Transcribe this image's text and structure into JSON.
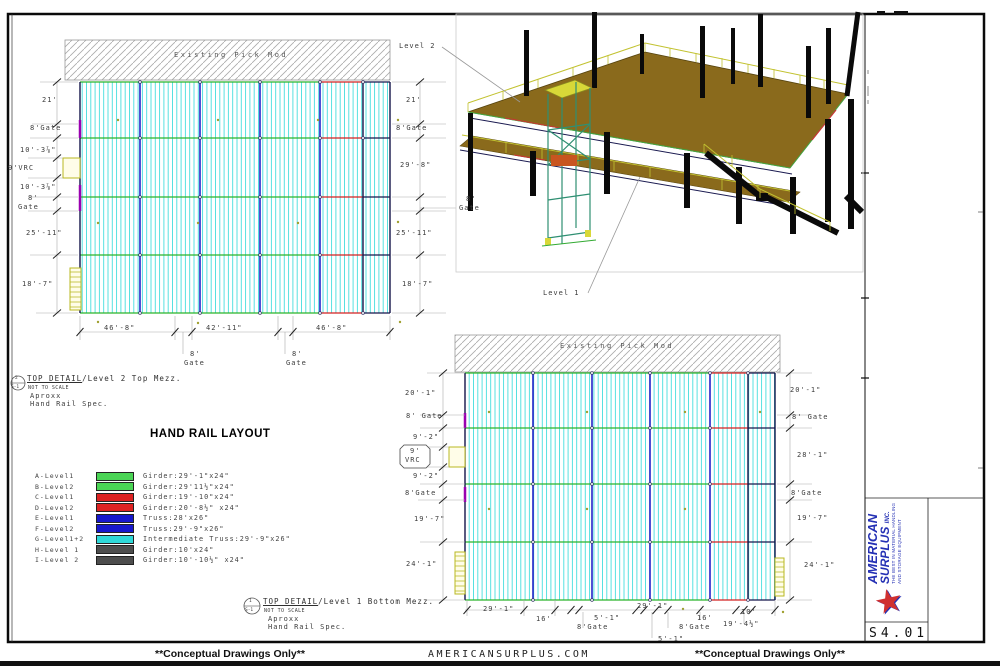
{
  "sheet": {
    "number": "S4.01"
  },
  "footer": {
    "left": "**Conceptual Drawings Only**",
    "center": "AMERICANSURPLUS.COM",
    "right": "**Conceptual Drawings Only**"
  },
  "logo": {
    "line1": "AMERICAN",
    "line2": "SURPLUS",
    "suffix": "INC.",
    "tagline1": "THE BEST IN MATERIAL HANDLING",
    "tagline2": "AND STORAGE EQUIPMENT"
  },
  "view3d": {
    "level2_label": "Level 2",
    "level1_label": "Level 1"
  },
  "legend": {
    "title": "HAND RAIL LAYOUT",
    "items": [
      {
        "key": "A-Level1",
        "color": "#4ad455",
        "label": "Girder:29'-1\"x24\""
      },
      {
        "key": "B-Level2",
        "color": "#4ad455",
        "label": "Girder:29'11½\"x24\""
      },
      {
        "key": "C-Level1",
        "color": "#dd2222",
        "label": "Girder:19'-10\"x24\""
      },
      {
        "key": "D-Level2",
        "color": "#dd2222",
        "label": "Girder:20'-8½\" x24\""
      },
      {
        "key": "E-Level1",
        "color": "#1717cc",
        "label": "Truss:28'x26\""
      },
      {
        "key": "F-Level2",
        "color": "#1717cc",
        "label": "Truss:29'-9\"x26\""
      },
      {
        "key": "G-Level1+2",
        "color": "#2fd8d8",
        "label": "Intermediate Truss:29'-9\"x26\""
      },
      {
        "key": "H-Level 1",
        "color": "#4d4d4d",
        "label": "Girder:10'x24\""
      },
      {
        "key": "I-Level 2",
        "color": "#4d4d4d",
        "label": "Girder:10'-10½\" x24\""
      }
    ]
  },
  "plan2": {
    "existing": "Existing Pick Mod",
    "left": {
      "d1": "21'",
      "d2": "8'Gate",
      "d3": "10'-3⅞\"",
      "d4": "9'VRC",
      "d5": "10'-3⅞\"",
      "d6": "8'",
      "d7": "Gate",
      "d8": "25'-11\"",
      "d9": "18'-7\""
    },
    "right": {
      "d1": "21'",
      "d2": "8'Gate",
      "d3": "29'-8\"",
      "d4": "25'-11\"",
      "d5": "18'-7\""
    },
    "gate_callout": {
      "a": "8'",
      "b": "Gate"
    },
    "bottom": {
      "d1": "46'-8\"",
      "d2": "42'-11\"",
      "d3": "46'-8\"",
      "g1a": "8'",
      "g1b": "Gate",
      "g2a": "8'",
      "g2b": "Gate"
    },
    "caption": {
      "bubble_top": "2",
      "bubble_bot": "S-1",
      "ref": "TOP DETAIL",
      "title": "/Level 2 Top Mezz.",
      "scale": "NOT TO SCALE",
      "note1": "Aproxx",
      "note2": "Hand Rail Spec."
    }
  },
  "plan1": {
    "existing": "Existing Pick Mod",
    "left": {
      "d1": "20'-1\"",
      "d2": "8' Gate",
      "d3": "9'-2\"",
      "d4a": "9'",
      "d4b": "VRC",
      "d5": "9'-2\"",
      "d6": "8'Gate",
      "d7": "19'-7\"",
      "d8": "24'-1\""
    },
    "right": {
      "d1": "20'-1\"",
      "d2": "8' Gate",
      "d3": "28'-1\"",
      "d4": "8'Gate",
      "d5": "19'-7\"",
      "d6": "24'-1\""
    },
    "bottom": {
      "d1": "29'-1\"",
      "d2": "16'",
      "d3": "8'Gate",
      "d4": "5'-1\"",
      "d5": "29'-1\"",
      "d6": "5'-1\"",
      "d7": "8'Gate",
      "d8": "16'",
      "d9": "19'-4½\"",
      "d10": "10'"
    },
    "caption": {
      "bubble_top": "1",
      "bubble_bot": "S-1",
      "ref": "TOP DETAIL",
      "title": "/Level 1 Bottom Mezz.",
      "scale": "NOT TO SCALE",
      "note1": "Aproxx",
      "note2": "Hand Rail Spec."
    }
  }
}
